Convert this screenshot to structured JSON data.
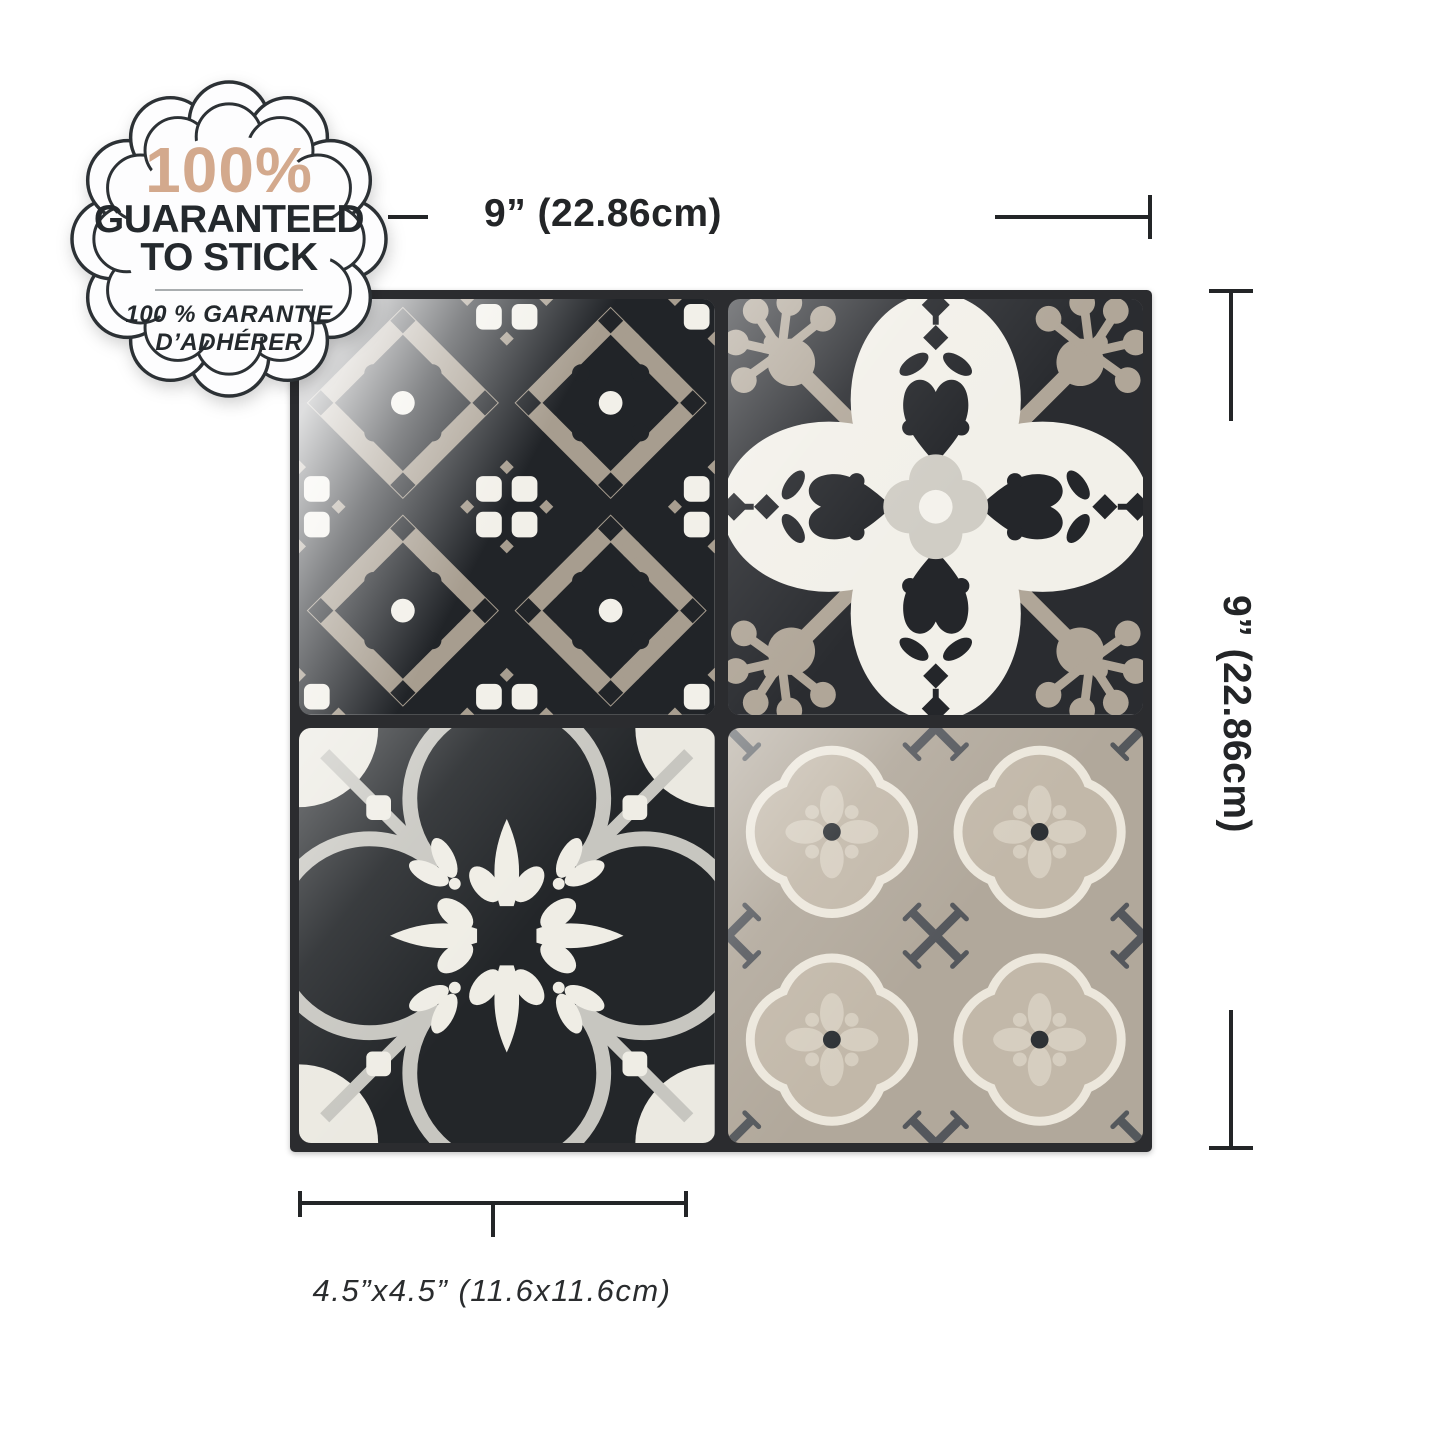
{
  "badge": {
    "headline": "100%",
    "headline_color": "#d3a98d",
    "title_line1": "GUARANTEED",
    "title_line2": "TO STICK",
    "subtitle_line1": "100 % GARANTIE",
    "subtitle_line2": "D’ADHÉRER",
    "text_color": "#24292d",
    "ring_color": "#2c3135"
  },
  "dimensions": {
    "top": {
      "label": "9” (22.86cm)"
    },
    "right": {
      "label": "9” (22.86cm)"
    },
    "bottom": {
      "label": "4.5”x4.5” (11.6x11.6cm)"
    },
    "line_color": "#232527"
  },
  "tile_panel": {
    "rows": 2,
    "cols": 2,
    "grout_color": "#2b2c2f",
    "tiles": [
      {
        "id": "damask-scroll",
        "colors": {
          "background": "#212428",
          "motif": "#a79d8f",
          "accent": "#f2f0e9"
        }
      },
      {
        "id": "petal-flower",
        "colors": {
          "background": "#2a2c30",
          "petal": "#f2f0e9",
          "corner": "#b0a698",
          "center": "#d0cdc5"
        }
      },
      {
        "id": "quatrefoil-medallion",
        "colors": {
          "background": "#232629",
          "ring": "#c7c6c0",
          "ornament": "#efede5"
        }
      },
      {
        "id": "rosette-grid",
        "colors": {
          "background": "#b1a89b",
          "rosette": "#c2b8a9",
          "outline": "#ece7dc",
          "cross": "#4b4f56"
        }
      }
    ]
  }
}
